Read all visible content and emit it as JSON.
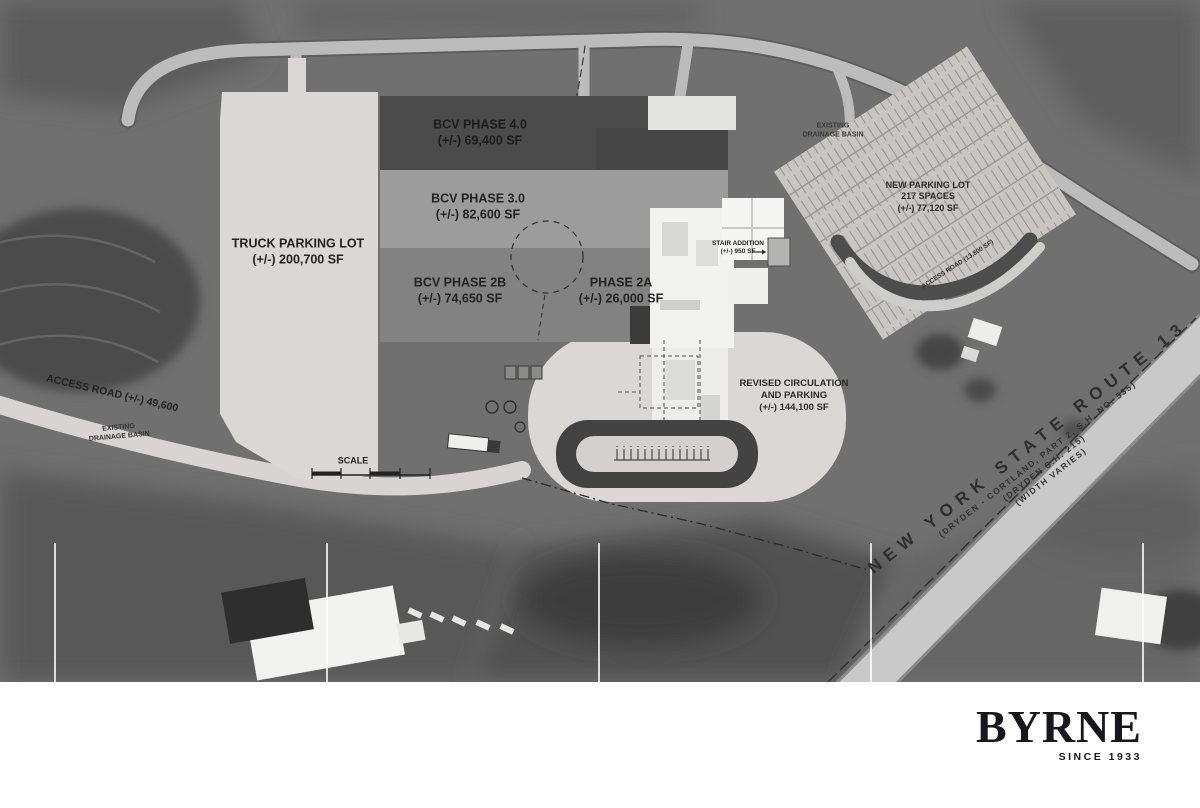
{
  "plan": {
    "areas": {
      "truck_lot": {
        "name": "TRUCK PARKING LOT",
        "size": "(+/-) 200,700 SF"
      },
      "phase4": {
        "name": "BCV PHASE 4.0",
        "size": "(+/-) 69,400 SF"
      },
      "phase3": {
        "name": "BCV PHASE 3.0",
        "size": "(+/-) 82,600 SF"
      },
      "phase2b": {
        "name": "BCV PHASE 2B",
        "size": "(+/-) 74,650 SF"
      },
      "phase2a": {
        "name": "PHASE 2A",
        "size": "(+/-) 26,000 SF"
      },
      "new_parking": {
        "name": "NEW PARKING LOT",
        "spaces": "217 SPACES",
        "size": "(+/-) 77,120 SF"
      },
      "stair": {
        "name": "STAIR ADDITION",
        "size": "(+/-) 950 SF"
      },
      "revised": {
        "line1": "REVISED CIRCULATION",
        "line2": "AND PARKING",
        "size": "(+/-) 144,100 SF"
      },
      "access_sw": "ACCESS ROAD (+/-) 49,600",
      "access_ne": "ACCESS ROAD (13,800 SF)",
      "drain_ne": {
        "line1": "EXISTING",
        "line2": "DRAINAGE BASIN"
      },
      "drain_sw": {
        "line1": "EXISTING",
        "line2": "DRAINAGE BASIN"
      },
      "scale": "SCALE"
    },
    "route13": {
      "name": "NEW YORK STATE ROUTE 13",
      "ref1": "(DRYDEN - CORTLAND, PART 2, S.H. NO. 535)",
      "ref2": "(DRYDEN S.H. 215)",
      "ref3": "(WIDTH VARIES)"
    }
  },
  "branding": {
    "logo": "BYRNE",
    "tagline": "SINCE 1933"
  },
  "colors": {
    "page": "#ffffff",
    "photo_base": "#707070",
    "overlay_light": "#d9d8d4",
    "phase4": "#4b4b4b",
    "phase3": "#9c9c9c",
    "phase2": "#828282",
    "building_white": "#f2f2f1",
    "road": "#bcbcbc",
    "route13_band": "#c9c9c9",
    "dark_drive": "#4d4d4d",
    "ink": "#262626"
  }
}
